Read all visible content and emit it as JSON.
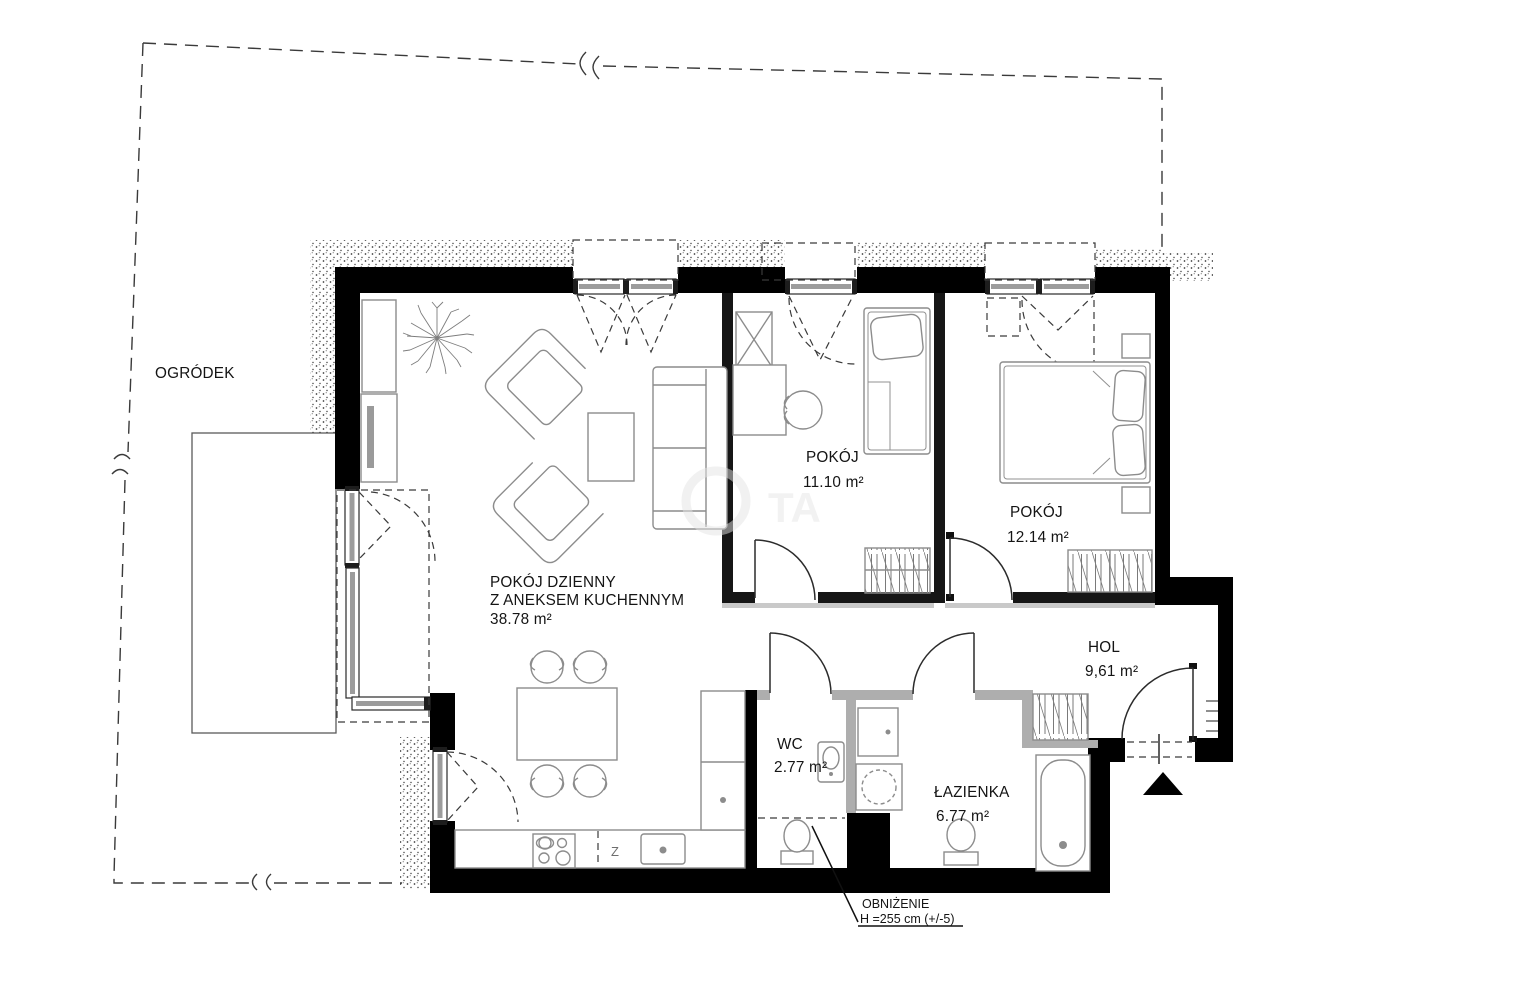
{
  "plan": {
    "title": "apartment-floor-plan",
    "garden_label": "OGRÓDEK",
    "rooms": {
      "living": {
        "name_line1": "POKÓJ DZIENNY",
        "name_line2": "Z ANEKSEM KUCHENNYM",
        "area": "38.78 m²"
      },
      "room1": {
        "name": "POKÓJ",
        "area": "11.10 m²"
      },
      "room2": {
        "name": "POKÓJ",
        "area": "12.14 m²"
      },
      "hall": {
        "name": "HOL",
        "area": "9,61 m²"
      },
      "wc": {
        "name": "WC",
        "area": "2.77 m²"
      },
      "bathroom": {
        "name": "ŁAZIENKA",
        "area": "6.77 m²"
      }
    },
    "annotations": {
      "ceiling_note_line1": "OBNIŻENIE",
      "ceiling_note_line2": "H =255 cm (+/-5)",
      "kitchen_sink_symbol": "Z",
      "watermark": "TA"
    },
    "colors": {
      "wall": "#000000",
      "light_partition": "#aeaeae",
      "furniture_line": "#8c8c8c",
      "dashed_line": "#3a3a3a",
      "background": "#ffffff"
    }
  }
}
